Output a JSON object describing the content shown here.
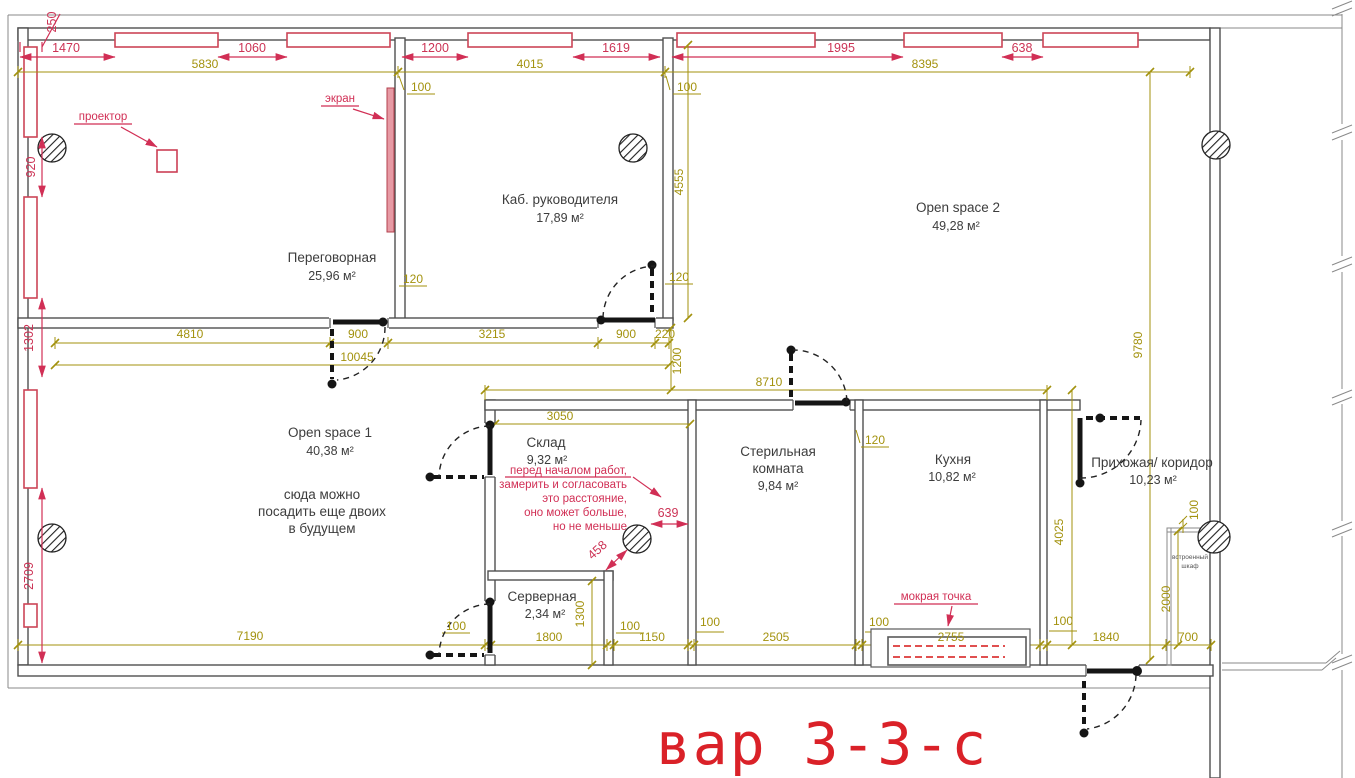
{
  "title": "вар 3-3-с",
  "colors": {
    "dim_olive": "#a3920e",
    "dim_red": "#cc3355",
    "annotation_red": "#d12f55",
    "title_red": "#da2128",
    "wall_gray": "#4f4f4f"
  },
  "rooms": [
    {
      "line1": "Переговорная",
      "area": "25,96 м²"
    },
    {
      "line1": "Каб. руководителя",
      "area": "17,89 м²"
    },
    {
      "line1": "Open space 2",
      "area": "49,28 м²"
    },
    {
      "line1": "Open space 1",
      "area": "40,38 м²"
    },
    {
      "line1": "Склад",
      "area": "9,32 м²"
    },
    {
      "line1": "Стерильная",
      "line2": "комната",
      "area": "9,84 м²"
    },
    {
      "line1": "Кухня",
      "area": "10,82 м²"
    },
    {
      "line1": "Прихожая/ коридор",
      "area": "10,23 м²"
    },
    {
      "line1": "Серверная",
      "area": "2,34 м²"
    }
  ],
  "labels": {
    "projector": "проектор",
    "screen": "экран",
    "wet_point": "мокрая точка",
    "closet1": "встроенный",
    "closet2": "шкаф"
  },
  "notes": {
    "open_space": [
      "сюда можно",
      "посадить еще двоих",
      "в будущем"
    ],
    "measure": [
      "перед началом работ,",
      "замерить и согласовать",
      "это расстояние,",
      "оно может больше,",
      "но не меньше"
    ]
  },
  "dims": {
    "r250": "250",
    "top_red": [
      "1470",
      "1060",
      "1200",
      "1619",
      "1995",
      "638"
    ],
    "top_olive": [
      "5830",
      "4015",
      "8395"
    ],
    "left_red": [
      "920",
      "1302",
      "2709"
    ],
    "mid_chain": [
      "4810",
      "900",
      "3215",
      "900",
      "220"
    ],
    "mid_total": "10045",
    "verticals": [
      "4555",
      "1200",
      "9780",
      "4025",
      "2000",
      "1300"
    ],
    "inner": [
      "8710",
      "3050"
    ],
    "thickness": [
      "100",
      "100",
      "120",
      "120",
      "120",
      "100"
    ],
    "bottom": [
      "7190",
      "100",
      "1800",
      "100",
      "1150",
      "100",
      "2505",
      "100",
      "2755",
      "100",
      "1840",
      "700"
    ],
    "red_inner": [
      "639",
      "458"
    ]
  }
}
